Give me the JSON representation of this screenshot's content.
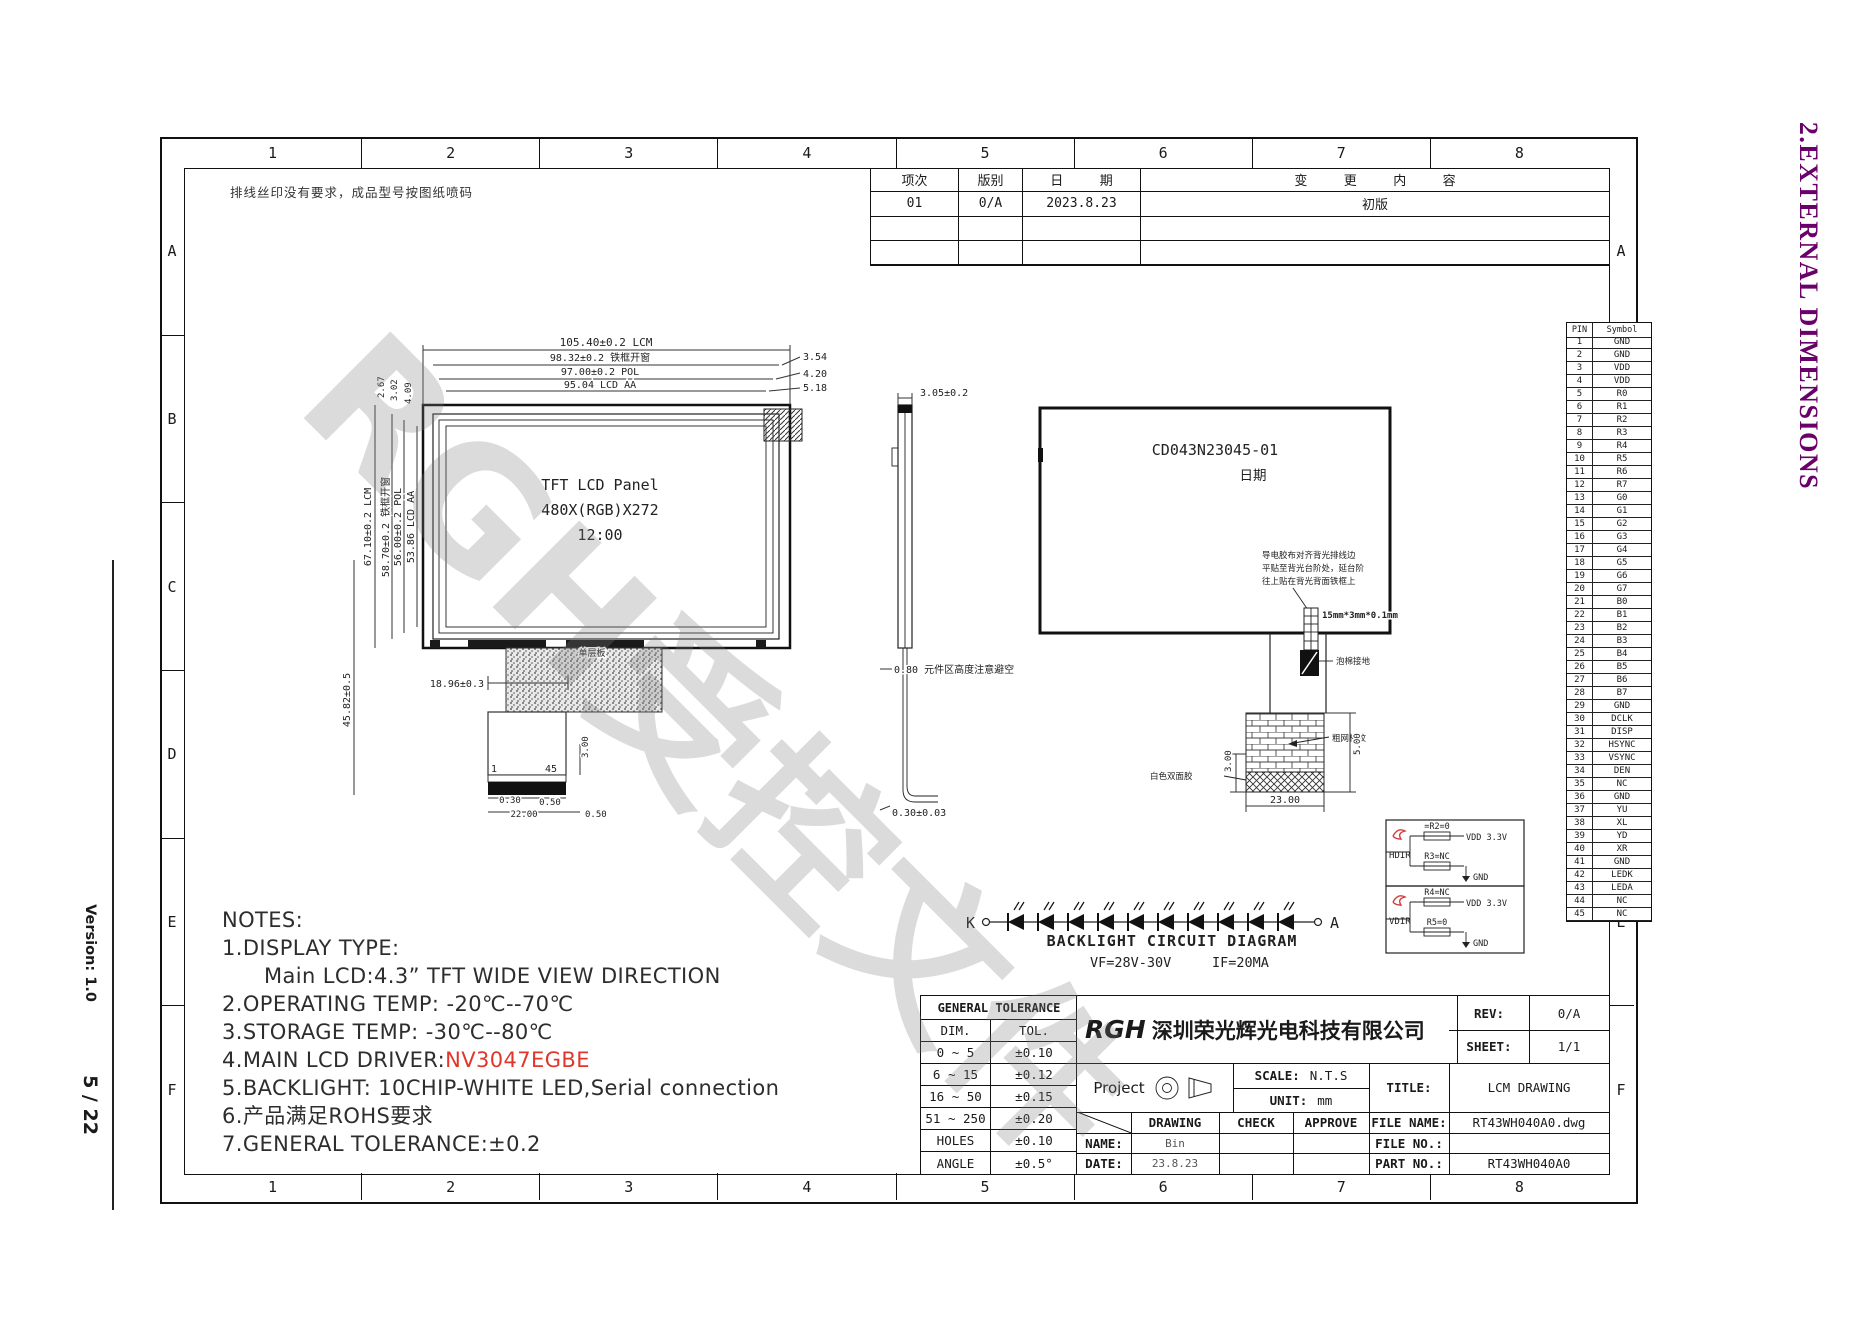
{
  "page": {
    "side_title": "2.EXTERNAL DIMENSIONS",
    "version_label": "Version: 1.0",
    "page_number": "5 / 22",
    "watermark": "RGH受控文件",
    "top_note": "排线丝印没有要求，成品型号按图纸喷码"
  },
  "frame": {
    "columns": [
      "1",
      "2",
      "3",
      "4",
      "5",
      "6",
      "7",
      "8"
    ],
    "rows": [
      "A",
      "B",
      "C",
      "D",
      "E",
      "F"
    ]
  },
  "revision_table": {
    "headers": [
      "项次",
      "版别",
      "日 期",
      "变 更 内 容"
    ],
    "rows": [
      [
        "01",
        "0/A",
        "2023.8.23",
        "初版"
      ],
      [
        "",
        "",
        "",
        ""
      ],
      [
        "",
        "",
        "",
        ""
      ]
    ]
  },
  "front_view": {
    "panel_line1": "TFT LCD Panel",
    "panel_line2": "480X(RGB)X272",
    "panel_line3": "12:00",
    "dim_top1": "105.40±0.2 LCM",
    "dim_top2": "98.32±0.2 铁框开窗",
    "dim_top3": "97.00±0.2 POL",
    "dim_top4": "95.04 LCD AA",
    "dim_right1": "3.54",
    "dim_right2": "4.20",
    "dim_right3": "5.18",
    "dim_ls1": "2.67",
    "dim_ls2": "3.02",
    "dim_ls3": "4.09",
    "dim_left1": "67.10±0.2 LCM",
    "dim_left2": "58.70±0.2 铁框开窗",
    "dim_left3": "56.00±0.2 POL",
    "dim_left4": "53.86 LCD AA",
    "dim_total_h": "45.82±0.5",
    "dim_fpc_w": "18.96±0.3",
    "fpc_layer_label": "单层板",
    "pin_first": "1",
    "pin_last": "45",
    "dim_030": "0.30",
    "dim_050a": "0.50",
    "dim_2200": "22.00",
    "dim_050b": "0.50",
    "dim_300": "3.00"
  },
  "side_view": {
    "dim_top": "3.05±0.2",
    "dim_component": "0.80 元件区高度注意避空",
    "dim_bottom": "0.30±0.03"
  },
  "rear_view": {
    "model": "CD043N23045-01",
    "date_label": "日期",
    "note1": "导电胶布对齐背光排线边",
    "note2": "平贴至背光台阶处，延台阶",
    "note3": "往上贴在背光背面铁框上",
    "tape_label": "15mm*3mm*0.1mm",
    "ground_label": "泡棉接地",
    "grid_label": "粗网格纹",
    "white_tape_label": "白色双面胶",
    "dim_300": "3.00",
    "dim_500": "5.00",
    "dim_2300": "23.00"
  },
  "backlight": {
    "title": "BACKLIGHT CIRCUIT DIAGRAM",
    "vf": "VF=28V-30V",
    "if": "IF=20MA",
    "k_label": "K",
    "a_label": "A",
    "led_count": 10,
    "circuit1": {
      "name": "HDIR",
      "r_top": "=R2=0",
      "v_top": "VDD 3.3V",
      "r_bot": "R3=NC",
      "gnd": "GND"
    },
    "circuit2": {
      "name": "VDIR",
      "r_top": "R4=NC",
      "v_top": "VDD 3.3V",
      "r_bot": "R5=0",
      "gnd": "GND"
    }
  },
  "pin_table": {
    "headers": [
      "PIN",
      "Symbol"
    ],
    "pins": [
      [
        "1",
        "GND"
      ],
      [
        "2",
        "GND"
      ],
      [
        "3",
        "VDD"
      ],
      [
        "4",
        "VDD"
      ],
      [
        "5",
        "R0"
      ],
      [
        "6",
        "R1"
      ],
      [
        "7",
        "R2"
      ],
      [
        "8",
        "R3"
      ],
      [
        "9",
        "R4"
      ],
      [
        "10",
        "R5"
      ],
      [
        "11",
        "R6"
      ],
      [
        "12",
        "R7"
      ],
      [
        "13",
        "G0"
      ],
      [
        "14",
        "G1"
      ],
      [
        "15",
        "G2"
      ],
      [
        "16",
        "G3"
      ],
      [
        "17",
        "G4"
      ],
      [
        "18",
        "G5"
      ],
      [
        "19",
        "G6"
      ],
      [
        "20",
        "G7"
      ],
      [
        "21",
        "B0"
      ],
      [
        "22",
        "B1"
      ],
      [
        "23",
        "B2"
      ],
      [
        "24",
        "B3"
      ],
      [
        "25",
        "B4"
      ],
      [
        "26",
        "B5"
      ],
      [
        "27",
        "B6"
      ],
      [
        "28",
        "B7"
      ],
      [
        "29",
        "GND"
      ],
      [
        "30",
        "DCLK"
      ],
      [
        "31",
        "DISP"
      ],
      [
        "32",
        "HSYNC"
      ],
      [
        "33",
        "VSYNC"
      ],
      [
        "34",
        "DEN"
      ],
      [
        "35",
        "NC"
      ],
      [
        "36",
        "GND"
      ],
      [
        "37",
        "YU"
      ],
      [
        "38",
        "XL"
      ],
      [
        "39",
        "YD"
      ],
      [
        "40",
        "XR"
      ],
      [
        "41",
        "GND"
      ],
      [
        "42",
        "LEDK"
      ],
      [
        "43",
        "LEDA"
      ],
      [
        "44",
        "NC"
      ],
      [
        "45",
        "NC"
      ]
    ]
  },
  "notes": {
    "title": "NOTES:",
    "lines": [
      {
        "text": "1.DISPLAY TYPE:"
      },
      {
        "text": "Main LCD:4.3” TFT  WIDE VIEW DIRECTION",
        "indent": true
      },
      {
        "text": "2.OPERATING TEMP: -20℃--70℃"
      },
      {
        "text": "3.STORAGE TEMP: -30℃--80℃"
      },
      {
        "text": "4.MAIN LCD DRIVER:",
        "red": "NV3047EGBE"
      },
      {
        "text": "5.BACKLIGHT: 10CHIP-WHITE LED,Serial connection"
      },
      {
        "text": "6.产品满足ROHS要求"
      },
      {
        "text": "7.GENERAL TOLERANCE:±0.2"
      }
    ]
  },
  "tolerance_table": {
    "title": "GENERAL TOLERANCE",
    "headers": [
      "DIM.",
      "TOL."
    ],
    "rows": [
      [
        "0 ~ 5",
        "±0.10"
      ],
      [
        "6 ~ 15",
        "±0.12"
      ],
      [
        "16 ~ 50",
        "±0.15"
      ],
      [
        "51 ~ 250",
        "±0.20"
      ],
      [
        "HOLES",
        "±0.10"
      ],
      [
        "ANGLE",
        "±0.5°"
      ]
    ]
  },
  "title_block": {
    "logo": "RGH",
    "company": "深圳荣光辉光电科技有限公司",
    "rev_label": "REV:",
    "rev": "0/A",
    "sheet_label": "SHEET:",
    "sheet": "1/1",
    "project_label": "Project",
    "scale_label": "SCALE:",
    "scale": "N.T.S",
    "unit_label": "UNIT:",
    "unit": "mm",
    "drawing_label": "DRAWING",
    "check_label": "CHECK",
    "approve_label": "APPROVE",
    "name_label": "NAME:",
    "name": "Bin",
    "date_label": "DATE:",
    "date": "23.8.23",
    "title_label": "TITLE:",
    "title": "LCM DRAWING",
    "file_name_label": "FILE NAME:",
    "file_name": "RT43WH040A0.dwg",
    "file_no_label": "FILE NO.:",
    "file_no": "",
    "part_no_label": "PART NO.:",
    "part_no": "RT43WH040A0"
  }
}
